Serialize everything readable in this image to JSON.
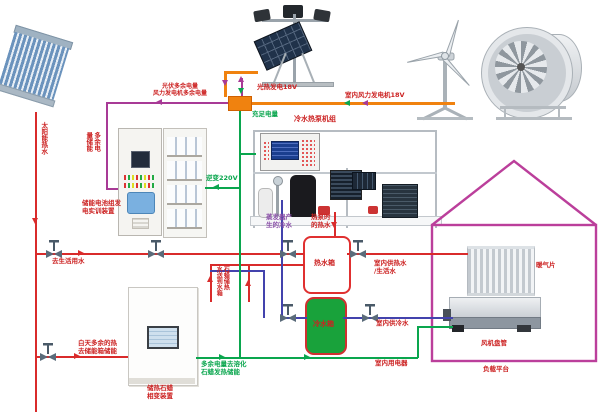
{
  "colors": {
    "pipe_hot": "#d92b2b",
    "pipe_cold": "#4343ad",
    "wire_power_green": "#0aa64e",
    "wire_excess_magenta": "#a83a96",
    "wire_source_orange": "#f0820f",
    "house_outline": "#bb3f9b",
    "label_red": "#cc2222",
    "cold_tank_fill": "#19a23b"
  },
  "labels": {
    "solar_pipe": "太阳能热水",
    "pv_gen": "光热发电18V",
    "wind_gen": "室内风力发电机18V",
    "excess_line1": "光伏多余电量",
    "excess_line2": "风力发电机多余电量",
    "sufficient": "充足电量",
    "battery_store_col1": "多余电",
    "battery_store_col2": "量储能",
    "battery_device_line1": "储能电池组发",
    "battery_device_line2": "电实训装置",
    "inverter": "逆变220V",
    "heat_pump_title": "冷水热泵机组",
    "evaporator_line1": "蒸发器产",
    "evaporator_line2": "生的冷水",
    "hp_hot_line1": "热泵时",
    "hp_hot_line2": "的热水",
    "hot_tank": "热水箱",
    "cold_tank": "冷水箱",
    "domestic_water": "去生活用水",
    "supply_hot_line1": "室内供热水",
    "supply_hot_line2": "/生活水",
    "supply_cold": "室内供冷水",
    "appliances": "室内用电器",
    "paraffin_to_tank_col1": "石蜡储热",
    "paraffin_to_tank_col2": "水送到水箱",
    "daytime_line1": "白天多余的热",
    "daytime_line2": "去储能箱储能",
    "melt_line1": "多余电量去溶化",
    "melt_line2": "石蜡发热储能",
    "paraffin_device_line1": "储热石蜡",
    "paraffin_device_line2": "相变装置",
    "radiator": "暖气片",
    "fan_coil": "风机盘管",
    "load_platform": "负载平台"
  }
}
